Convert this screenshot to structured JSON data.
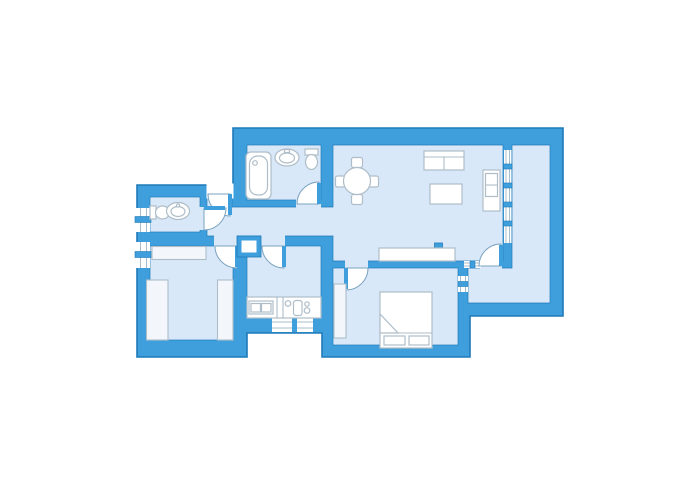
{
  "diagram_type": "apartment-floor-plan",
  "canvas": {
    "width": 700,
    "height": 500
  },
  "colors": {
    "background": "#ffffff",
    "wall": "#3f9fdd",
    "wall_outline": "#1f7ab8",
    "floor": "#d9e8f8",
    "furniture_fill": "#ffffff",
    "furniture_outline": "#aebdc8",
    "soft_fill": "#f3f7fb",
    "door_arc": "#7aa3c0",
    "window_jamb": "#a8bccb"
  }
}
